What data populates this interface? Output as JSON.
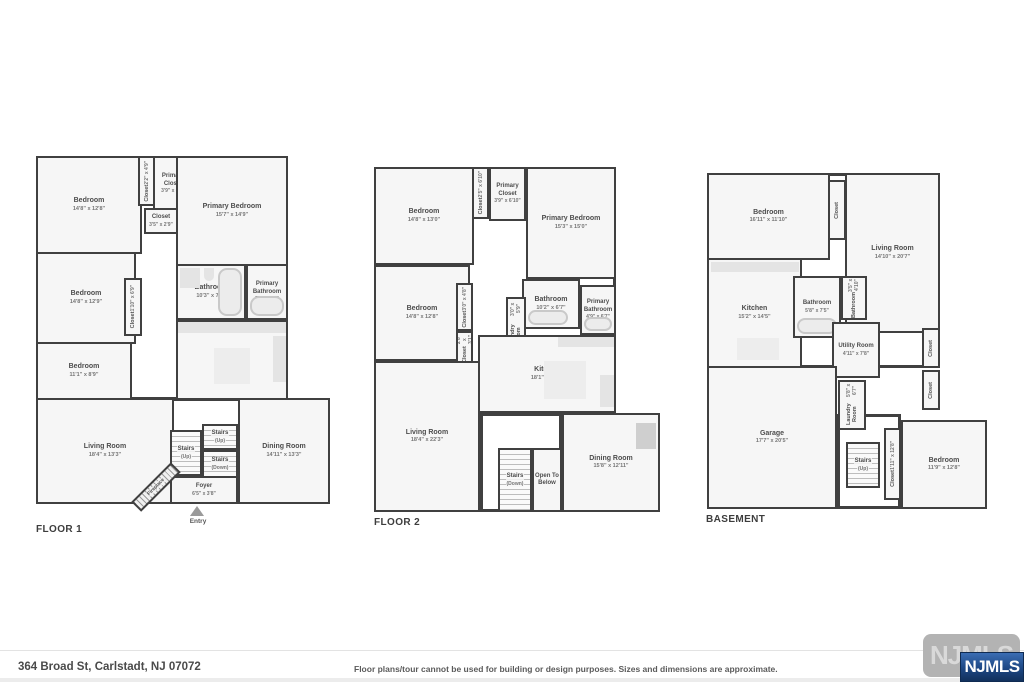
{
  "footer": {
    "address": "364 Broad St, Carlstadt, NJ 07072",
    "disclaimer": "Floor plans/tour cannot be used for building or design purposes. Sizes and dimensions are approximate."
  },
  "logo": {
    "watermark": "NJMLS",
    "text": "NJMLS"
  },
  "floor1": {
    "label": "FLOOR 1",
    "entry": "Entry",
    "rooms": {
      "bedroom1": {
        "name": "Bedroom",
        "dims": "14'8\" x 12'8\""
      },
      "closet1": {
        "name": "Closet",
        "dims": "2'2\" x 4'9\""
      },
      "primary_closet": {
        "name": "Primary Closet",
        "dims": "3'9\" x 6'9\""
      },
      "closet2": {
        "name": "Closet",
        "dims": "3'5\" x 2'9\""
      },
      "primary_bedroom": {
        "name": "Primary Bedroom",
        "dims": "15'7\" x 14'9\""
      },
      "bedroom2": {
        "name": "Bedroom",
        "dims": "14'8\" x 12'9\""
      },
      "closet3": {
        "name": "Closet",
        "dims": "1'10\" x 6'9\""
      },
      "bathroom": {
        "name": "Bathroom",
        "dims": "10'3\" x 7'1\""
      },
      "primary_bathroom": {
        "name": "Primary Bathroom",
        "dims": "5'8\" x 7'7\""
      },
      "kitchen": {
        "name": "Kitchen",
        "dims": "15'7\" x 12'5\""
      },
      "bedroom3": {
        "name": "Bedroom",
        "dims": "11'1\" x 8'9\""
      },
      "living": {
        "name": "Living Room",
        "dims": "18'4\" x 13'3\""
      },
      "stairs_up1": {
        "name": "Stairs",
        "note": "(Up)"
      },
      "stairs_up2": {
        "name": "Stairs",
        "note": "(Up)"
      },
      "stairs_down": {
        "name": "Stairs",
        "note": "(Down)"
      },
      "foyer": {
        "name": "Foyer",
        "dims": "6'5\" x 3'8\""
      },
      "dining": {
        "name": "Dining Room",
        "dims": "14'11\" x 13'3\""
      },
      "fireplace": {
        "name": "Fireplace"
      }
    }
  },
  "floor2": {
    "label": "FLOOR 2",
    "rooms": {
      "bedroom1": {
        "name": "Bedroom",
        "dims": "14'8\" x 13'0\""
      },
      "closet1": {
        "name": "Closet",
        "dims": "2'5\" x 6'10\""
      },
      "primary_closet": {
        "name": "Primary Closet",
        "dims": "3'9\" x 6'10\""
      },
      "primary_bedroom": {
        "name": "Primary Bedroom",
        "dims": "15'3\" x 15'0\""
      },
      "bedroom2": {
        "name": "Bedroom",
        "dims": "14'8\" x 12'8\""
      },
      "closet2": {
        "name": "Closet",
        "dims": "3'0\" x 4'8\""
      },
      "closet3": {
        "name": "Closet",
        "dims": "2'8\" x 3'1\""
      },
      "bathroom": {
        "name": "Bathroom",
        "dims": "10'2\" x 6'7\""
      },
      "primary_bathroom": {
        "name": "Primary Bathroom",
        "dims": "4'9\" x 6'7\""
      },
      "laundry": {
        "name": "Laundry Room",
        "dims": "3'0\" x 5'9\""
      },
      "kitchen": {
        "name": "Kitchen",
        "dims": "18'1\" x 13'9\""
      },
      "living": {
        "name": "Living Room",
        "dims": "18'4\" x 22'3\""
      },
      "stairs_down": {
        "name": "Stairs",
        "note": "(Down)"
      },
      "open_below": {
        "name": "Open To Below"
      },
      "dining": {
        "name": "Dining Room",
        "dims": "15'8\" x 12'11\""
      }
    }
  },
  "basement": {
    "label": "BASEMENT",
    "rooms": {
      "bedroom1": {
        "name": "Bedroom",
        "dims": "16'11\" x 11'10\""
      },
      "closet1": {
        "name": "Closet"
      },
      "living": {
        "name": "Living Room",
        "dims": "14'10\" x 20'7\""
      },
      "kitchen": {
        "name": "Kitchen",
        "dims": "15'2\" x 14'5\""
      },
      "bathroom1": {
        "name": "Bathroom",
        "dims": "5'8\" x 7'5\""
      },
      "bathroom2": {
        "name": "Bathroom",
        "dims": "3'5\" x 4'10\""
      },
      "utility": {
        "name": "Utility Room",
        "dims": "4'11\" x 7'8\""
      },
      "closet2": {
        "name": "Closet"
      },
      "closet3": {
        "name": "Closet"
      },
      "laundry": {
        "name": "Laundry Room",
        "dims": "5'8\" x 6'7\""
      },
      "garage": {
        "name": "Garage",
        "dims": "17'7\" x 20'5\""
      },
      "stairs_up": {
        "name": "Stairs",
        "note": "(Up)"
      },
      "closet4": {
        "name": "Closet",
        "dims": "1'11\" x 12'8\""
      },
      "bedroom2": {
        "name": "Bedroom",
        "dims": "11'9\" x 12'8\""
      }
    }
  }
}
